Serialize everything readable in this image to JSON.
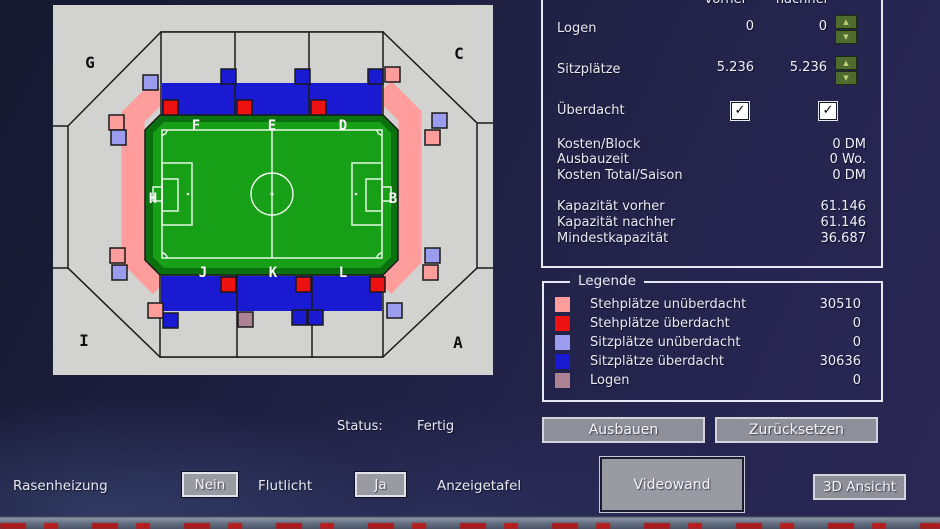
{
  "stadium": {
    "corner_labels": {
      "tl": "G",
      "tr": "C",
      "bl": "I",
      "br": "A"
    },
    "block_labels": {
      "top": [
        "F",
        "E",
        "D"
      ],
      "left": "H",
      "right": "B",
      "bottom": [
        "J",
        "K",
        "L"
      ]
    }
  },
  "capacity_panel": {
    "col_vorher": "vorher",
    "col_nachher": "nachher",
    "rows": [
      {
        "label": "Logen",
        "vorher": "0",
        "nachher": "0"
      },
      {
        "label": "Sitzplätze",
        "vorher": "5.236",
        "nachher": "5.236"
      }
    ],
    "ueberdacht_label": "Überdacht",
    "stats": [
      {
        "label": "Kosten/Block",
        "value": "0 DM"
      },
      {
        "label": "Ausbauzeit",
        "value": "0 Wo."
      },
      {
        "label": "Kosten Total/Saison",
        "value": "0 DM"
      },
      {
        "label": "Kapazität vorher",
        "value": "61.146"
      },
      {
        "label": "Kapazität nachher",
        "value": "61.146"
      },
      {
        "label": "Mindestkapazität",
        "value": "36.687"
      }
    ]
  },
  "legend": {
    "title": "Legende",
    "items": [
      {
        "label": "Stehplätze unüberdacht",
        "value": "30510",
        "color": "#ff9d9d"
      },
      {
        "label": "Stehplätze überdacht",
        "value": "0",
        "color": "#ee1111"
      },
      {
        "label": "Sitzplätze unüberdacht",
        "value": "0",
        "color": "#9c9cee"
      },
      {
        "label": "Sitzplätze überdacht",
        "value": "30636",
        "color": "#1a1ad2"
      },
      {
        "label": "Logen",
        "value": "0",
        "color": "#ad8295"
      }
    ]
  },
  "status": {
    "label": "Status:",
    "value": "Fertig"
  },
  "buttons": {
    "ausbauen": "Ausbauen",
    "zuruecksetzen": "Zurücksetzen",
    "videowand": "Videowand",
    "ansicht_3d": "3D Ansicht",
    "rasenheizung_value": "Nein",
    "flutlicht_value": "Ja"
  },
  "toggles": {
    "rasenheizung_label": "Rasenheizung",
    "flutlicht_label": "Flutlicht",
    "anzeigetafel_label": "Anzeigetafel"
  }
}
